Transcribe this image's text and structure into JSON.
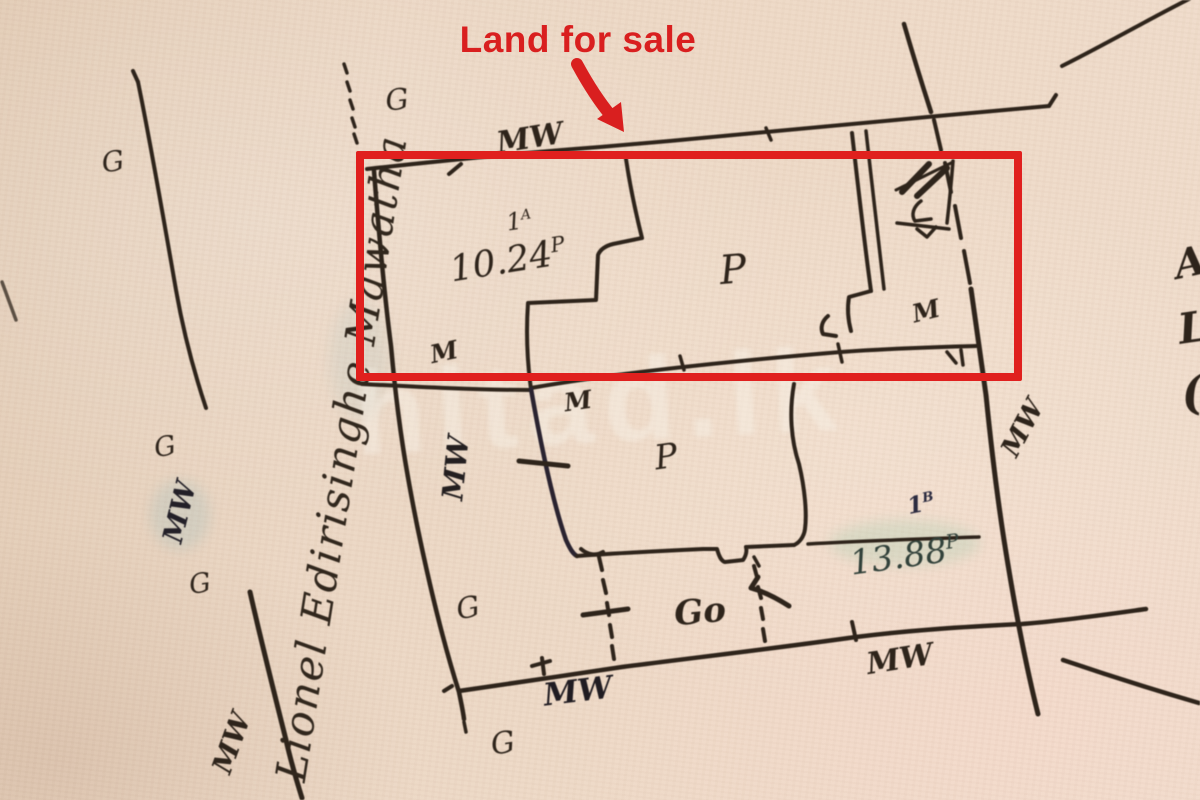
{
  "annotation": {
    "text": "Land for sale"
  },
  "road": {
    "name": "Lionel Edirisinghe Mawatha"
  },
  "plots": [
    {
      "lot_prefix": "1",
      "lot_sup": "A",
      "area_main": "10.24",
      "area_sup": "P"
    },
    {
      "lot_prefix": "1",
      "lot_sup": "B",
      "area_main": "13.88",
      "area_sup": "P"
    }
  ],
  "marks": {
    "g": [
      "G",
      "G",
      "G",
      "G",
      "G",
      "G"
    ],
    "mw": [
      "MW",
      "MW",
      "MW",
      "MW",
      "MW",
      "MW",
      "MW"
    ],
    "m": [
      "M",
      "M",
      "M"
    ],
    "p": [
      "P",
      "P"
    ],
    "go": "Go"
  },
  "edge_letters": [
    "A",
    "L",
    "("
  ],
  "watermark": {
    "text": "hitad.lk"
  },
  "colors": {
    "highlight_red": "#e0201e",
    "annotation_red": "#d91f1f",
    "ink": "#2e241b",
    "paper": "#ecd7c4"
  }
}
